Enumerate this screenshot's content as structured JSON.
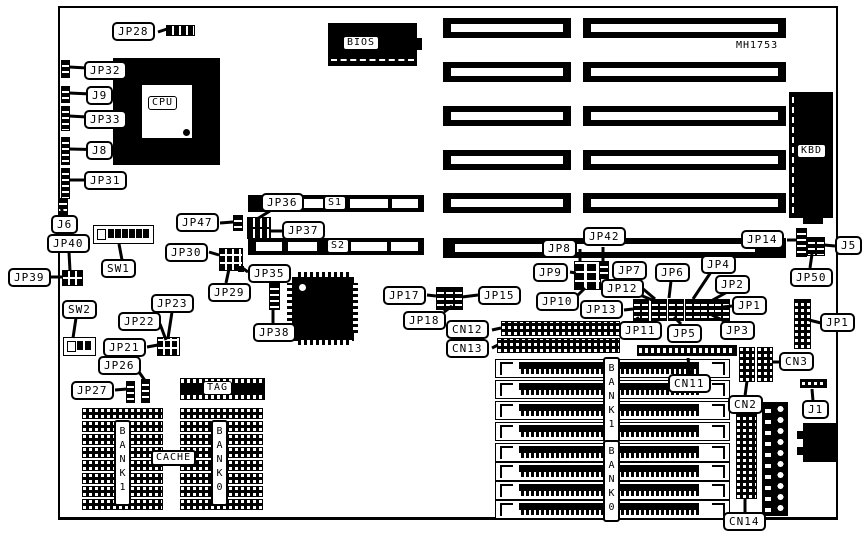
{
  "board": {
    "part_number": "MH1753",
    "components": {
      "cpu": "CPU",
      "bios": "BIOS",
      "keyboard_connector": "KBD",
      "vlb_slot_1": "S1",
      "vlb_slot_2": "S2",
      "tag_chip": "TAG",
      "cache_label": "CACHE",
      "cache_bank_left": "BANK 1",
      "cache_bank_right": "BANK 0",
      "simm_bank_top": "BANK 1",
      "simm_bank_bottom": "BANK 0"
    },
    "jumper_labels": {
      "jp28": "JP28",
      "jp32": "JP32",
      "j9": "J9",
      "jp33": "JP33",
      "j8": "J8",
      "jp31": "JP31",
      "j6": "J6",
      "jp40": "JP40",
      "jp39": "JP39",
      "sw1": "SW1",
      "sw2": "SW2",
      "jp23": "JP23",
      "jp22": "JP22",
      "jp21": "JP21",
      "jp26": "JP26",
      "jp27": "JP27",
      "jp47": "JP47",
      "jp36": "JP36",
      "jp37": "JP37",
      "jp30": "JP30",
      "jp35": "JP35",
      "jp29": "JP29",
      "jp38": "JP38",
      "jp17": "JP17",
      "jp15": "JP15",
      "jp18": "JP18",
      "cn12": "CN12",
      "cn13": "CN13",
      "jp8": "JP8",
      "jp42": "JP42",
      "jp9": "JP9",
      "jp7": "JP7",
      "jp12": "JP12",
      "jp10": "JP10",
      "jp13": "JP13",
      "jp6": "JP6",
      "jp4": "JP4",
      "jp2": "JP2",
      "jp1_row": "JP1",
      "jp3": "JP3",
      "jp5": "JP5",
      "jp11": "JP11",
      "jp14": "JP14",
      "j5": "J5",
      "jp50": "JP50",
      "jp1_header": "JP1",
      "cn3": "CN3",
      "cn2": "CN2",
      "cn11": "CN11",
      "j1": "J1",
      "cn14": "CN14"
    },
    "counts": {
      "expansion_slot_rows": 6,
      "simm_sockets": 8,
      "cache_chip_rows_per_bank": 8
    }
  }
}
